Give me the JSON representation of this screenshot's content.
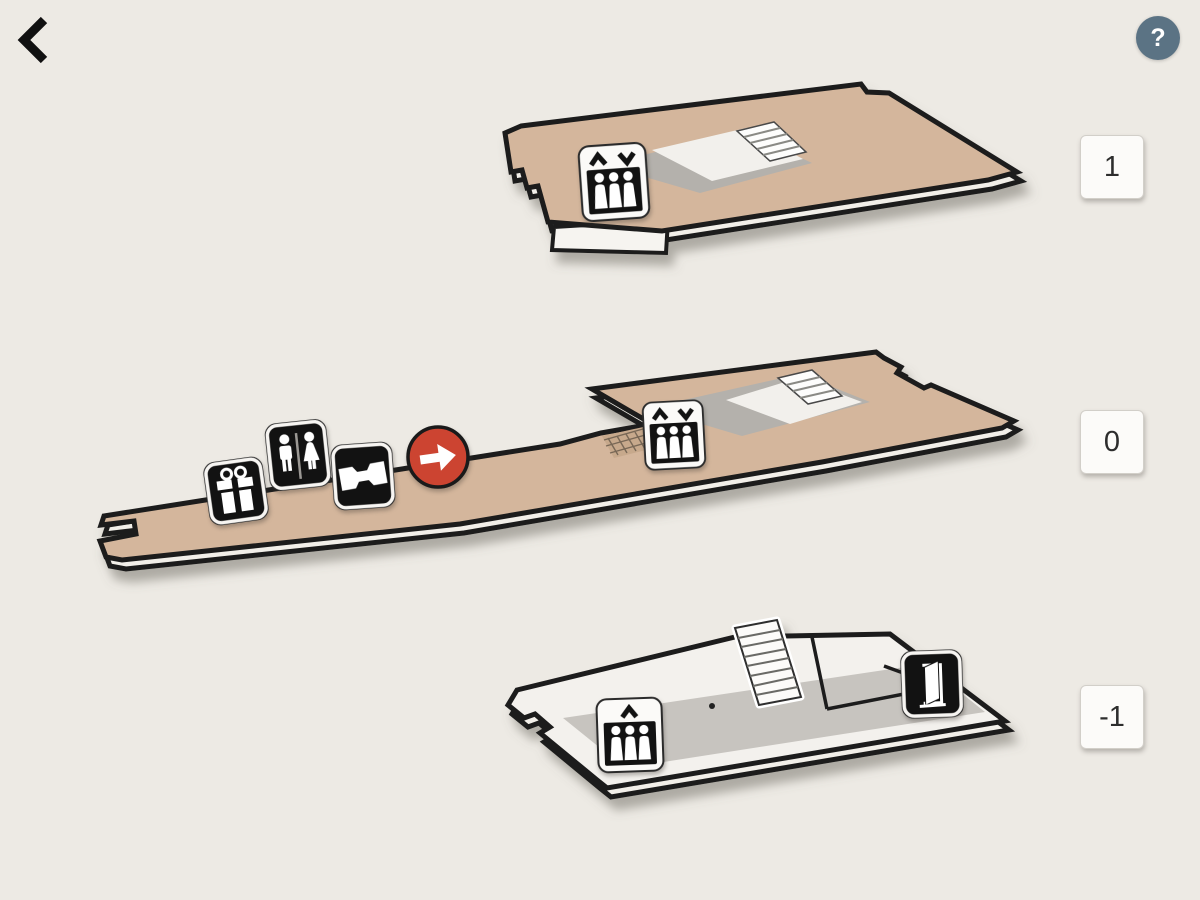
{
  "view": {
    "title": "building-floor-levels-map",
    "background": "#edeae4"
  },
  "header": {
    "back_icon": "chevron-left",
    "help_label": "?"
  },
  "floor_selector": {
    "buttons": [
      {
        "label": "1"
      },
      {
        "label": "0"
      },
      {
        "label": "-1"
      }
    ]
  },
  "floors": [
    {
      "level": "1",
      "fill": "#d4b69c",
      "features": [
        "stairwell-opening",
        "staircase",
        "balcony"
      ],
      "icons": [
        "elevator-up-down"
      ]
    },
    {
      "level": "0",
      "fill": "#d4b69c",
      "features": [
        "long-corridor",
        "stairwell-opening",
        "staircase",
        "hatched-ramp"
      ],
      "icons": [
        "gift-shop",
        "restrooms",
        "tickets",
        "you-are-here-arrow",
        "elevator-up-down"
      ]
    },
    {
      "level": "-1",
      "fill": "#f3f1ed",
      "features": [
        "staircase",
        "interior-walls",
        "shaded-area"
      ],
      "icons": [
        "elevator-up",
        "exit-door"
      ]
    }
  ],
  "colors": {
    "outline": "#1b1b1b",
    "floor_tan": "#d4b69c",
    "floor_light": "#f3f1ed",
    "interior_shadow": "#b4b1ac",
    "marker_red": "#cc4431",
    "help_button": "#5b7384",
    "selector_bg": "#fcfbf9",
    "selector_text": "#2d2d2d"
  }
}
